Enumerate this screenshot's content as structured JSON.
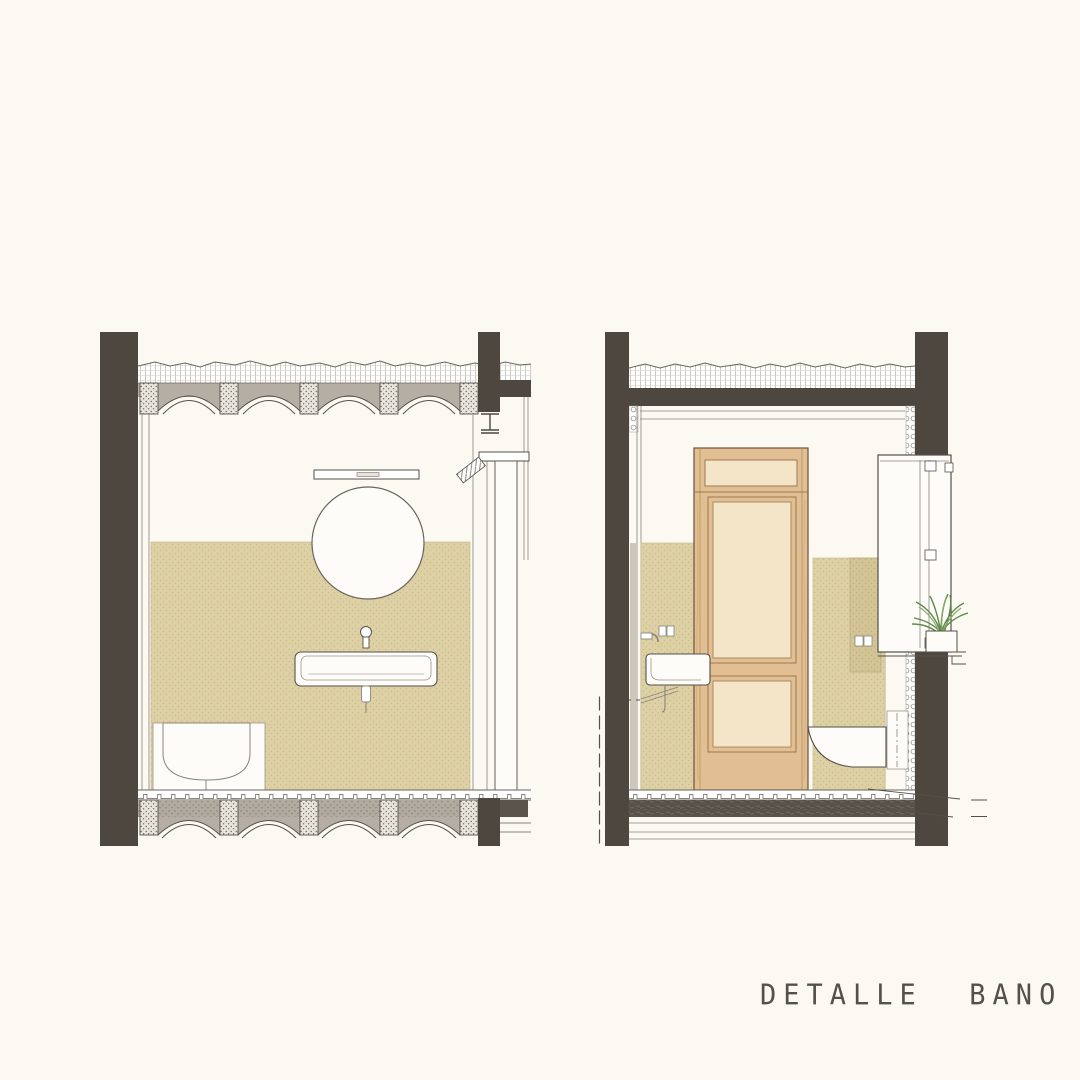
{
  "title": {
    "text": "DETALLE  BANO"
  },
  "colors": {
    "paper": "#fbf9f2",
    "structure": "#4e4740",
    "slab": "#b4aea5",
    "tile": "#ddd0a4",
    "tile-dark": "#d3c495",
    "wood": "#e2bf92",
    "wood-light": "#f4e5c8",
    "wood-line": "#9c7850",
    "wood-edge": "#6e5138",
    "plant": "#5f8a4a",
    "plant-light": "#86a86a",
    "ink": "#55504a",
    "ink-light": "#8a847c",
    "fixture-white": "#fdfcf8",
    "floor-dark": "#5b544c"
  },
  "drawing": {
    "kind": "architectural-section-detail",
    "left_section": {
      "name": "bathroom section front view",
      "elements": [
        "vaulted-beam-ceiling",
        "structural-columns",
        "light-fixture",
        "round-mirror",
        "wall-faucet",
        "wall-hung-washbasin",
        "wall-hung-toilet",
        "tiled-wainscot",
        "steel-beam",
        "door-jamb",
        "vaulted-floor-slab",
        "drain-pipes"
      ]
    },
    "right_section": {
      "name": "bathroom section side view",
      "elements": [
        "concrete-beam",
        "screed-layer",
        "structural-columns",
        "wood-door-with-transom",
        "side-washbasin",
        "double-socket",
        "wall-hung-toilet",
        "concealed-cistern",
        "tall-cabinet",
        "planter-plant",
        "tiled-walls",
        "insulation-layer",
        "dashed-drain-pipe",
        "floor-build-up",
        "leader-lines"
      ]
    }
  }
}
